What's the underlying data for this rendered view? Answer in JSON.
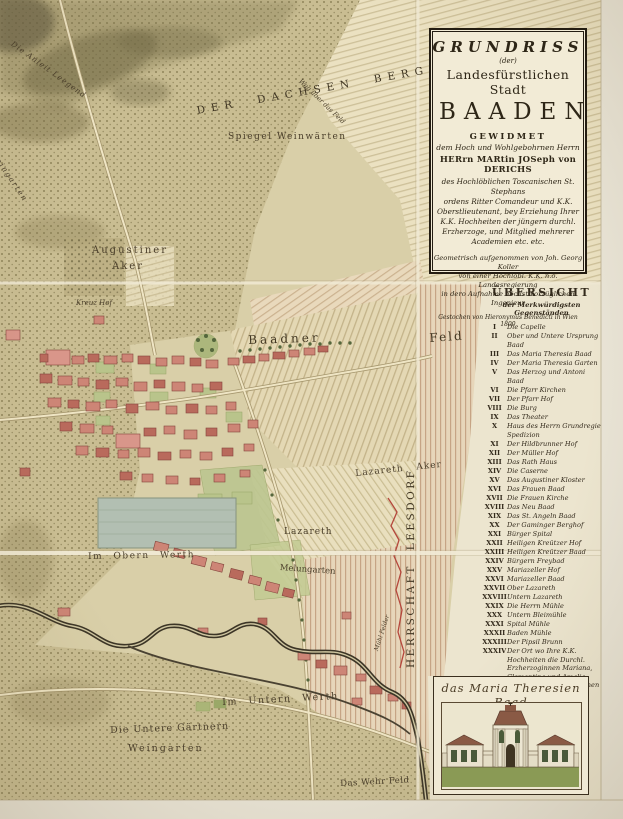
{
  "title_cartouche": {
    "line1": "GRUNDRISS",
    "line2": "(der)",
    "line3": "Landesfürstlichen Stadt",
    "line4": "BAADEN",
    "line5": "GEWIDMET",
    "line6": "dem Hoch und Wohlgebohrnen Herrn",
    "line7": "HERrn MARtin JOSeph von DERICHS",
    "dedication": [
      "des Hochlöblichen Toscanischen St. Stephans",
      "ordens Ritter Comandeur und K.K.",
      "Oberstlieutenant, bey Erziehung Ihrer",
      "K.K. Hochheiten der jüngern durchl.",
      "Erzherzoge, und Mitglied mehrerer",
      "Academien etc. etc."
    ],
    "surveyor": [
      "Geometrisch aufgenommen von Joh. Georg Koller",
      "von einer Hochlöbl. K.K. n.ö. Landesregierung",
      "in dero Aufnahme höchst vorzüglichen Ingenieur"
    ],
    "engraver": "Gestochen von Hieronymus Benedicti in Wien 1800"
  },
  "legend": {
    "header": "ÜBERSICHT",
    "subheader": "der Merkwürdigsten Gegenständen",
    "entries": [
      {
        "num": "I",
        "label": "Die Capelle"
      },
      {
        "num": "II",
        "label": "Ober und Untere Ursprung Baad"
      },
      {
        "num": "III",
        "label": "Das Maria Theresia Baad"
      },
      {
        "num": "IV",
        "label": "Der Maria Theresia Garten"
      },
      {
        "num": "V",
        "label": "Das Herzog und Antoni Baad"
      },
      {
        "num": "VI",
        "label": "Die Pfarr Kirchen"
      },
      {
        "num": "VII",
        "label": "Der Pfarr Hof"
      },
      {
        "num": "VIII",
        "label": "Die Burg"
      },
      {
        "num": "IX",
        "label": "Das Theater"
      },
      {
        "num": "X",
        "label": "Haus des Herrn Grundregie Spedizion"
      },
      {
        "num": "XI",
        "label": "Der Hildbrunner Hof"
      },
      {
        "num": "XII",
        "label": "Der Müller Hof"
      },
      {
        "num": "XIII",
        "label": "Das Rath Haus"
      },
      {
        "num": "XIV",
        "label": "Die Caserne"
      },
      {
        "num": "XV",
        "label": "Das Augustiner Kloster"
      },
      {
        "num": "XVI",
        "label": "Das Frauen Baad"
      },
      {
        "num": "XVII",
        "label": "Die Frauen Kirche"
      },
      {
        "num": "XVIII",
        "label": "Das Neu Baad"
      },
      {
        "num": "XIX",
        "label": "Das St. Angeln Baad"
      },
      {
        "num": "XX",
        "label": "Der Gaminger Berghof"
      },
      {
        "num": "XXI",
        "label": "Bürger Spital"
      },
      {
        "num": "XXII",
        "label": "Heiligen Kreützer Hof"
      },
      {
        "num": "XXIII",
        "label": "Heiligen Kreützer Baad"
      },
      {
        "num": "XXIV",
        "label": "Bürgern Freybad"
      },
      {
        "num": "XXV",
        "label": "Mariazeller Hof"
      },
      {
        "num": "XXVI",
        "label": "Mariazeller Baad"
      },
      {
        "num": "XXVII",
        "label": "Ober Lazareth"
      },
      {
        "num": "XXVIII",
        "label": "Untern Lazareth"
      },
      {
        "num": "XXIX",
        "label": "Die Herrn Mühle"
      },
      {
        "num": "XXX",
        "label": "Untern Bleimühle"
      },
      {
        "num": "XXXI",
        "label": "Spital Mühle"
      },
      {
        "num": "XXXII",
        "label": "Baden Mühle"
      },
      {
        "num": "XXXIII",
        "label": "Der Pipsil Brunn"
      },
      {
        "num": "XXXIV",
        "label": "Der Ort wo Ihre K.K. Hochheiten die Durchl. Erzherzoginnen Mariana, Clementina und Amalia, den 2. Sep 1792 mit eignen Händen Kreuz Schanzen gemacht haben."
      }
    ]
  },
  "vignette": {
    "caption": "das Maria Theresien Baad"
  },
  "map_labels": {
    "anleit": "Die Anleit Leegend",
    "weingarten_left": "Weingarten",
    "hill_name": "DER DACHSEN BERG",
    "spiegel": "Spiegel Weinwärten",
    "weg": "Weg über das Feld",
    "augustiner_1": "Augustiner",
    "augustiner_2": "Aker",
    "kreuz_hof": "Kreuz Hof",
    "baadner": "Baadner",
    "feld": "Feld",
    "lazareth_aker": "Lazareth Aker",
    "lazareth": "Lazareth",
    "melungarten": "Melungarten",
    "obern_werth": "Im Obern Werth",
    "untern_werth": "Im Untern Werth",
    "untere_gaertnern_1": "Die Untere Gärtnern",
    "untere_gaertnern_2": "Weingarten",
    "wehr_feld": "Das Wehr Feld",
    "herrschaft": "HERRSCHAFT LEESDORF",
    "muehl_felder": "Mühl Felder"
  },
  "colors": {
    "paper": "#f2ebd6",
    "map_base": "#d9cfa8",
    "hill_stipple": "#c9bd92",
    "field_line": "#c6b88e",
    "building_red": "#cd8576",
    "river_ink": "#3c3526",
    "legend_ink": "#332a1c",
    "red_boundary": "#b5473c"
  }
}
